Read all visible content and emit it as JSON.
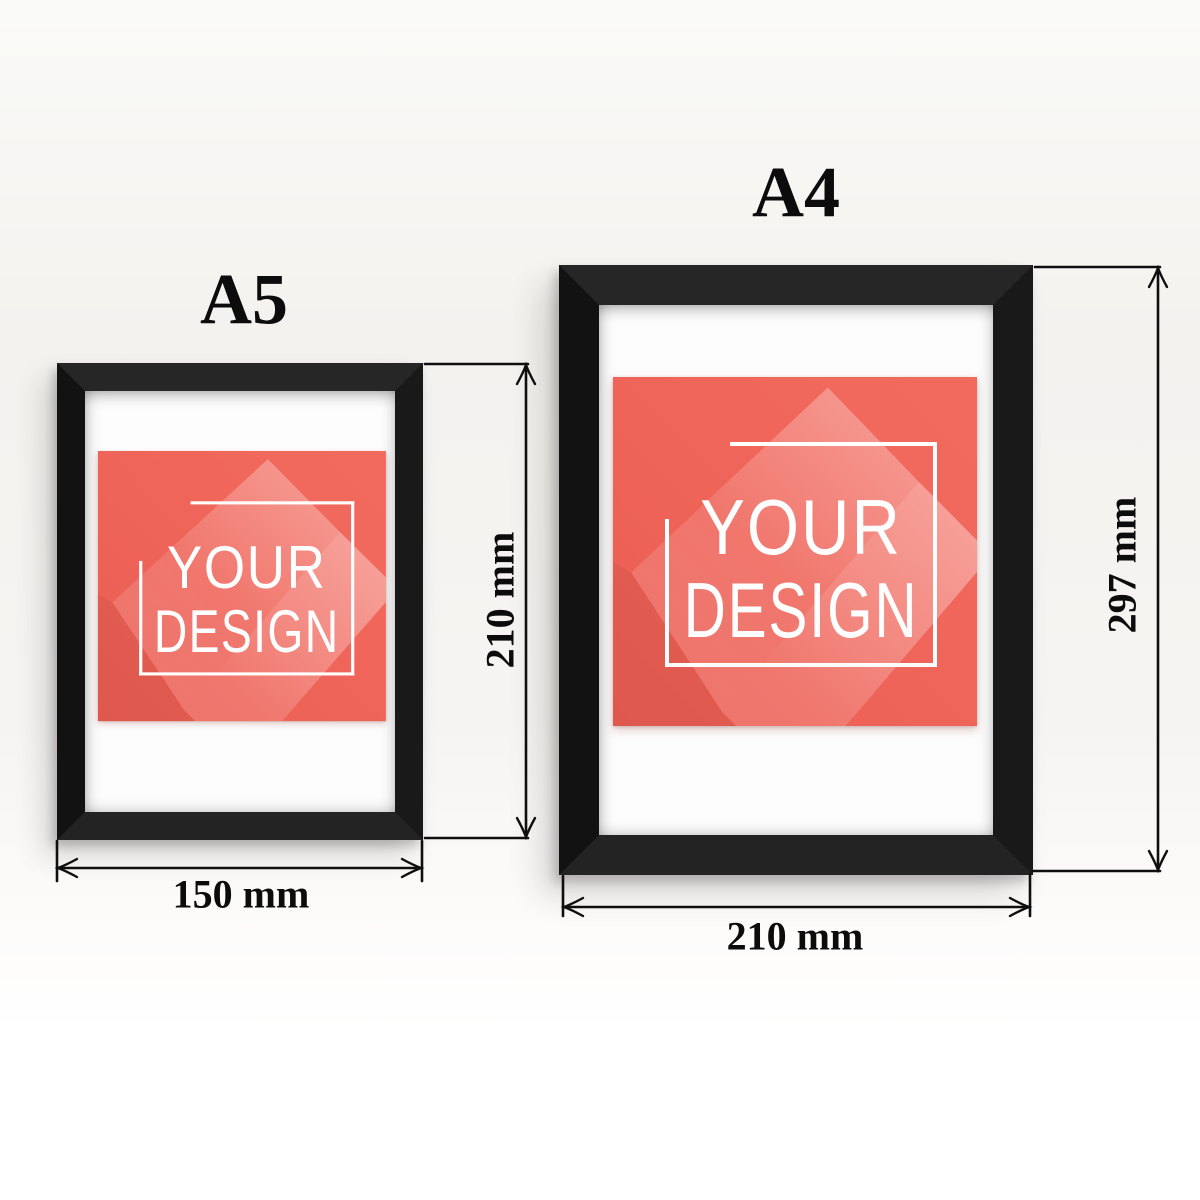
{
  "titles": {
    "a5": "A5",
    "a4": "A4"
  },
  "poster": {
    "line1": "YOUR",
    "line2": "DESIGN"
  },
  "dimensions": {
    "a5": {
      "width": "150 mm",
      "height": "210 mm"
    },
    "a4": {
      "width": "210 mm",
      "height": "297 mm"
    }
  },
  "colors": {
    "poster_red": "#ef6459",
    "frame_black": "#1d1d1d",
    "mat_white": "#fdfdfd",
    "wall": "#f6f4f2",
    "annotation_ink": "#0c0c0c",
    "poster_text": "#ffffff"
  }
}
